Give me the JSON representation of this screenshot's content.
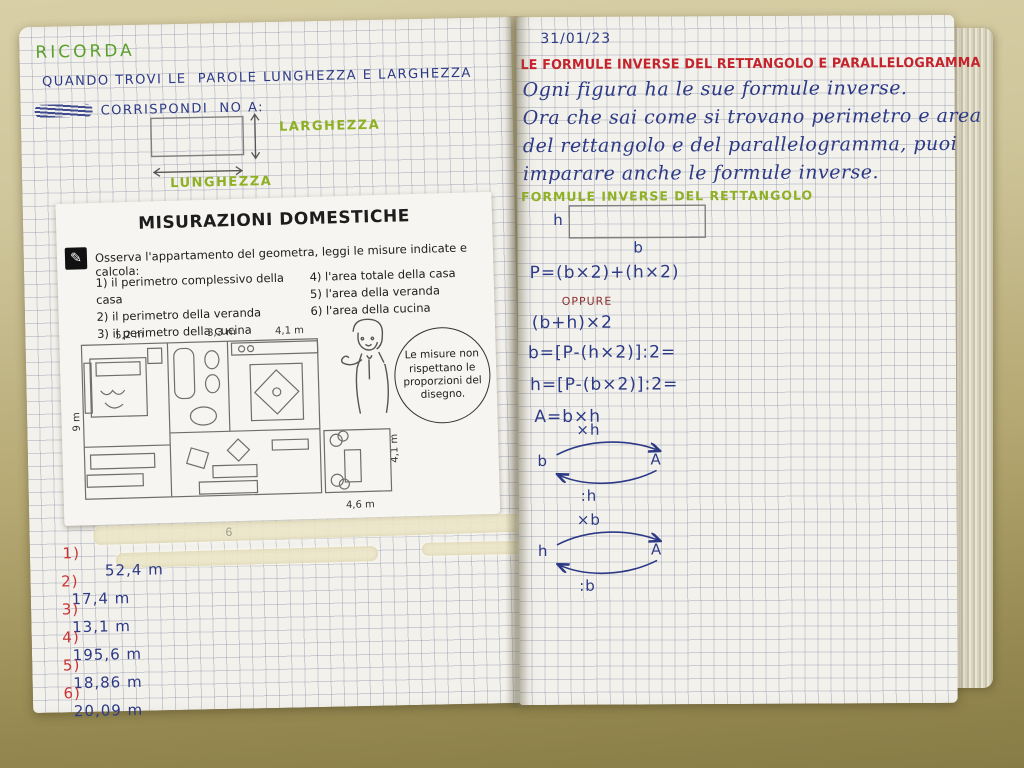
{
  "colors": {
    "pen_blue": "#2c3a86",
    "pen_green": "#5aa02c",
    "label_green": "#8fb024",
    "pen_red": "#c03030",
    "title_red": "#c4232b",
    "desk": "#a89a62",
    "correction_tape": "#ece6c9"
  },
  "left_page": {
    "heading": "RICORDA",
    "line1": "QUANDO TROVI LE  PAROLE LUNGHEZZA E LARGHEZZA",
    "line2": "CORRISPONDI  NO A:",
    "diagram": {
      "width_label": "LARGHEZZA",
      "length_label": "LUNGHEZZA"
    },
    "pencil_mark": "6",
    "answers": [
      {
        "label": "1)",
        "value": "52,4 m"
      },
      {
        "label": "2)",
        "value": "17,4 m"
      },
      {
        "label": "3)",
        "value": "13,1 m"
      },
      {
        "label": "4)",
        "value": "195,6 m"
      },
      {
        "label": "5)",
        "value": "18,86 m"
      },
      {
        "label": "6)",
        "value": "20,09 m"
      }
    ]
  },
  "worksheet": {
    "title": "MISURAZIONI DOMESTICHE",
    "icon": "pencil-icon",
    "icon_glyph": "✎",
    "instruction": "Osserva l'appartamento del geometra, leggi le misure indicate e calcola:",
    "tasks_left": [
      "1) il perimetro complessivo della casa",
      "2) il perimetro della veranda",
      "3) il perimetro della cucina"
    ],
    "tasks_right": [
      "4) l'area totale della casa",
      "5) l'area della veranda",
      "6) l'area della cucina"
    ],
    "plan": {
      "top_labels": [
        "5,2 m",
        "3,3 m",
        "4,1 m"
      ],
      "left_label": "9 m",
      "right_label": "4,1 m",
      "bottom_label": "4,6 m"
    },
    "speech_bubble": "Le misure non rispettano le proporzioni del disegno."
  },
  "right_page": {
    "date": "31/01/23",
    "title": "LE FORMULE INVERSE DEL RETTANGOLO E PARALLELOGRAMMA",
    "paragraph": [
      "Ogni figura ha le sue formule inverse.",
      "Ora che sai come si trovano perimetro e area",
      "del rettangolo e del parallelogramma, puoi",
      "imparare anche le formule inverse."
    ],
    "green_heading": "FORMULE INVERSE DEL RETTANGOLO",
    "rect_labels": {
      "h": "h",
      "b": "b"
    },
    "formulas": {
      "perimeter": "P=(b×2)+(h×2)",
      "or_word": "OPPURE",
      "alt": "(b+h)×2",
      "base": "b=[P-(h×2)]:2=",
      "height": "h=[P-(b×2)]:2=",
      "area": "A=b×h"
    },
    "arrows": [
      {
        "from": "b",
        "to": "A",
        "op_top": "×h",
        "op_bottom": ":h"
      },
      {
        "from": "h",
        "to": "A",
        "op_top": "×b",
        "op_bottom": ":b"
      }
    ]
  }
}
